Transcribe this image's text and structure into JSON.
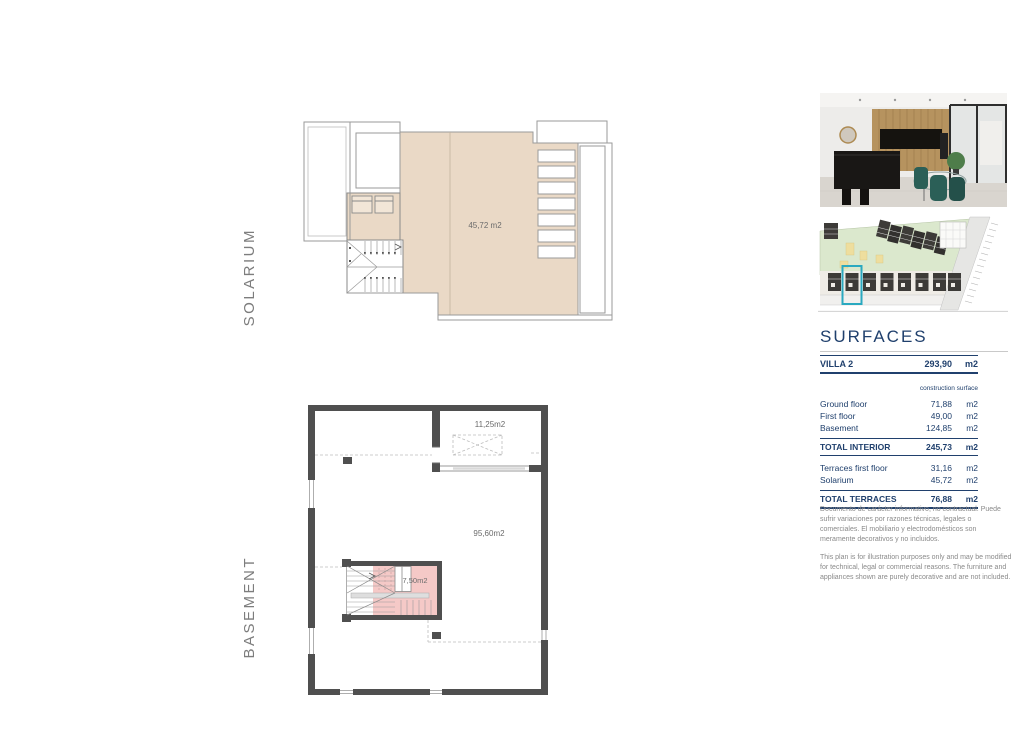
{
  "page": {
    "background": "#ffffff"
  },
  "plans": {
    "solarium": {
      "floor_label": "SOLARIUM",
      "area_label": "45,72 m2"
    },
    "basement": {
      "floor_label": "BASEMENT",
      "storage_area_label": "11,25m2",
      "main_area_label": "95,60m2",
      "stairs_area_label": "7,50m2"
    }
  },
  "surfaces": {
    "title": "SURFACES",
    "header": {
      "name": "VILLA 2",
      "value": "293,90",
      "unit": "m2"
    },
    "subheader": "construction surface",
    "interior_rows": [
      {
        "name": "Ground floor",
        "value": "71,88",
        "unit": "m2"
      },
      {
        "name": "First floor",
        "value": "49,00",
        "unit": "m2"
      },
      {
        "name": "Basement",
        "value": "124,85",
        "unit": "m2"
      }
    ],
    "total_interior": {
      "name": "TOTAL INTERIOR",
      "value": "245,73",
      "unit": "m2"
    },
    "terrace_rows": [
      {
        "name": "Terraces first floor",
        "value": "31,16",
        "unit": "m2"
      },
      {
        "name": "Solarium",
        "value": "45,72",
        "unit": "m2"
      }
    ],
    "total_terraces": {
      "name": "TOTAL TERRACES",
      "value": "76,88",
      "unit": "m2"
    }
  },
  "disclaimer": {
    "es": "Documento de carácter informativo, no contractual. Puede sufrir variaciones por razones técnicas, legales o comerciales. El mobiliario y electrodomésticos son meramente decorativos y no incluidos.",
    "en": "This plan is for illustration purposes only and may be modified for technical, legal or commercial reasons. The furniture and appliances shown are purely decorative and are not included."
  },
  "images": {
    "interior_photo_alt": "interior-kitchen-dining-photo",
    "site_plan_alt": "site-plan-with-highlighted-villa"
  },
  "colors": {
    "accent_navy": "#20406d",
    "terrace_beige": "#ead9c6",
    "stairs_pink": "#f5c9c7",
    "wall_dark": "#4f4f4f",
    "highlight_teal": "#2aa9c0"
  }
}
